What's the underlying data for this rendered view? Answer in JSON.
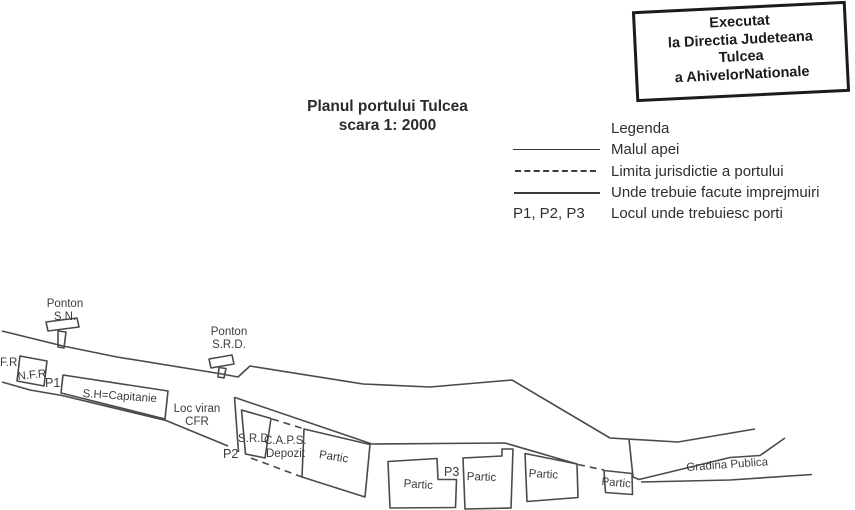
{
  "stamp": {
    "lines": [
      "Executat",
      "la Directia Judeteana",
      "Tulcea",
      "a AhivelorNationale"
    ]
  },
  "title": {
    "line1": "Planul portului Tulcea",
    "line2": "scara 1: 2000"
  },
  "legend": {
    "heading": "Legenda",
    "items": [
      {
        "symbol": "solid-thin",
        "label": "Malul apei"
      },
      {
        "symbol": "dashed",
        "label": "Limita jurisdictie a portului"
      },
      {
        "symbol": "solid-thick",
        "label": "Unde trebuie facute imprejmuiri"
      },
      {
        "symbol": "text",
        "symbol_text": "P1, P2, P3",
        "label": "Locul unde trebuiesc porti"
      }
    ]
  },
  "map": {
    "labels": {
      "ponton_sn_line1": "Ponton",
      "ponton_sn_line2": "S.N.",
      "ponton_srd_line1": "Ponton",
      "ponton_srd_line2": "S.R.D.",
      "fr": "F.R",
      "nfr": "N.F.R",
      "p1": "P1",
      "capitanie": "S.H=Capitanie",
      "loc_viran_line1": "Loc viran",
      "loc_viran_line2": "CFR",
      "srd": "S.R.D",
      "p2": "P2",
      "caps_line1": "C.A.P.S.",
      "caps_line2": "Depozit",
      "partic1": "Partic",
      "partic2": "Partic",
      "partic3": "Partic",
      "partic4": "Partic",
      "partic5": "Partic",
      "p3": "P3",
      "gradina": "Gradina Publica"
    }
  },
  "colors": {
    "line": "#4a4a4a",
    "text": "#3c3c3c",
    "stamp_border": "#1b1b1b",
    "background": "#ffffff"
  }
}
